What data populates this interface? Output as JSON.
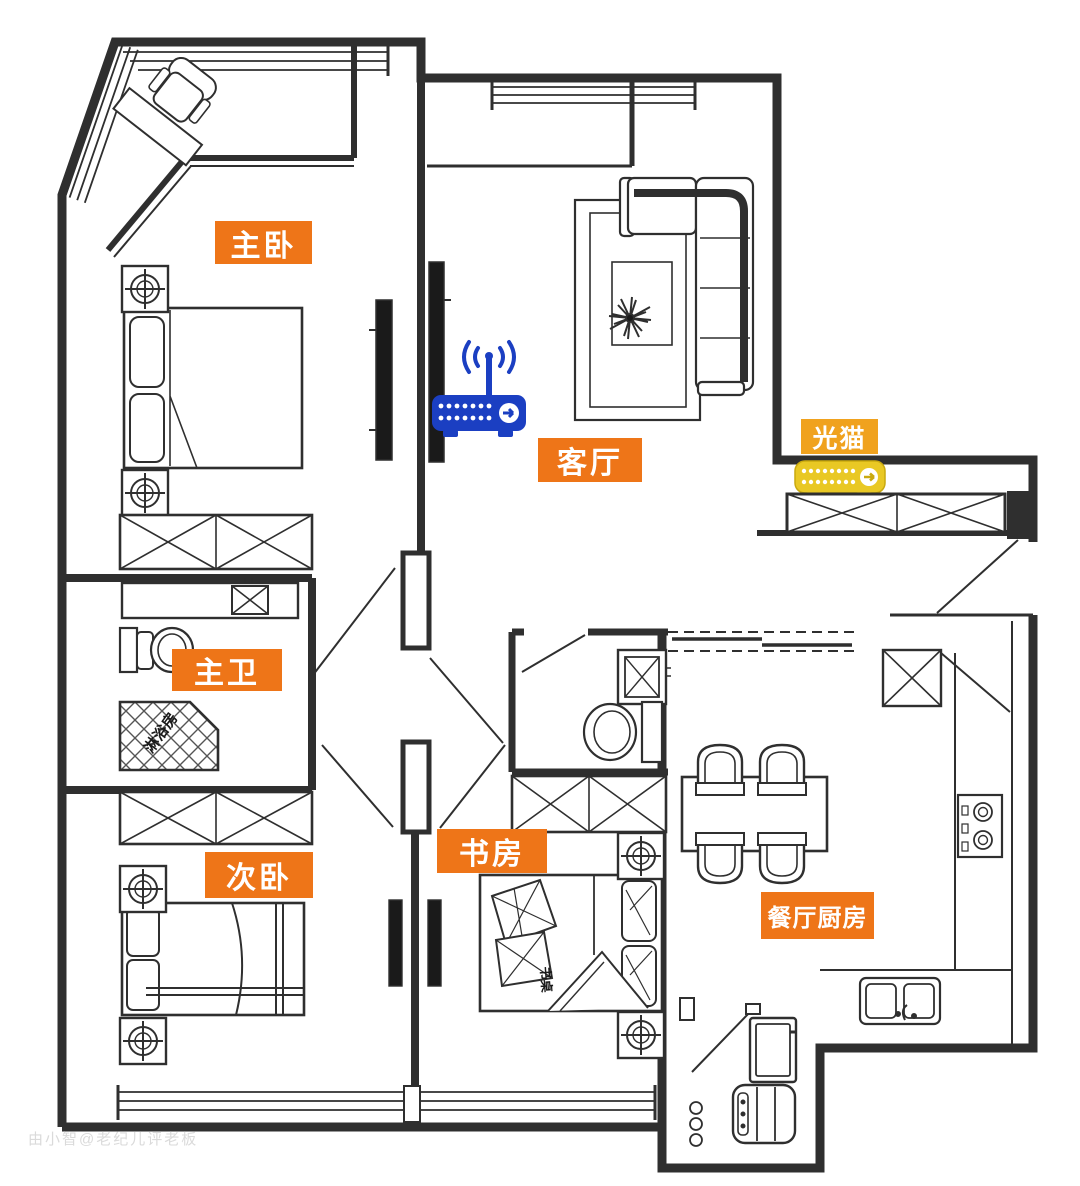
{
  "labels": {
    "master_bedroom": "主卧",
    "living_room": "客厅",
    "optical_modem": "光猫",
    "master_bathroom": "主卫",
    "shower_room": "淋浴房",
    "second_bedroom": "次卧",
    "study": "书房",
    "study_desk": "书桌",
    "dining_kitchen": "餐厅厨房"
  },
  "icons": {
    "router": "wifi-router-icon",
    "modem": "optical-modem-icon"
  },
  "colors": {
    "room_label_bg": "#ee7518",
    "modem_label_bg": "#f0a21e",
    "router_blue": "#1b3fc2",
    "modem_yellow": "#e9c824",
    "wall": "#2f2f2f",
    "watermark": "#dadada"
  },
  "watermark": "由小智@老纪儿评老板"
}
